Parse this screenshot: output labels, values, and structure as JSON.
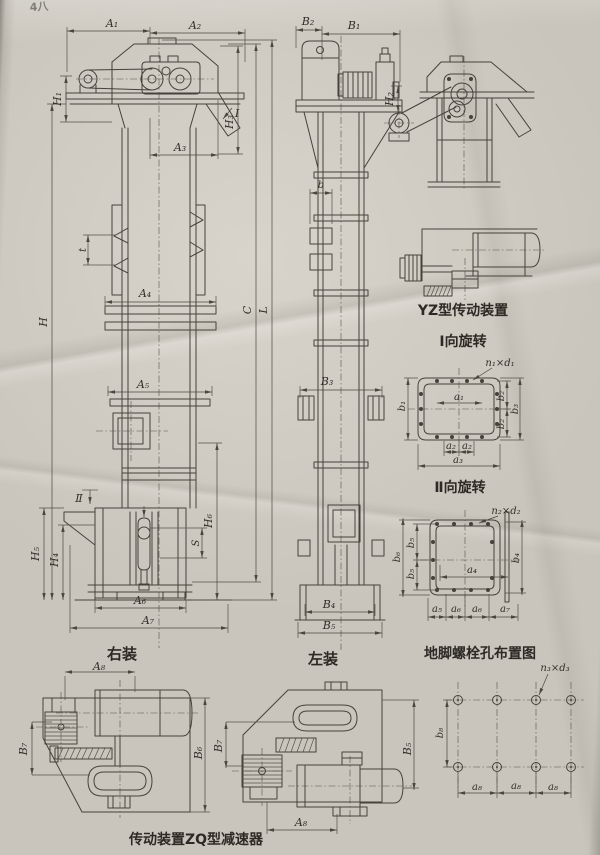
{
  "page": {
    "header_fragment": "4八",
    "views": {
      "front": {
        "caption": "右装",
        "dims": {
          "A1": "A₁",
          "A2": "A₂",
          "A3": "A₃",
          "A4": "A₄",
          "A5": "A₅",
          "A6": "A₆",
          "A7": "A₇",
          "H": "H",
          "H1": "H₁",
          "H3": "H₃",
          "H4": "H₄",
          "H5": "H₅",
          "H6": "H₆",
          "C": "C",
          "L": "L",
          "S": "S",
          "t": "t",
          "section1": "I",
          "section2": "Ⅱ"
        }
      },
      "side": {
        "caption": "左装",
        "dims": {
          "B1": "B₁",
          "B2": "B₂",
          "B3": "B₃",
          "B4": "B₄",
          "B5": "B₅",
          "H2": "H₂",
          "b": "b"
        }
      },
      "yz_drive": {
        "caption": "YZ型传动装置"
      },
      "flange1": {
        "caption": "Ⅰ向旋转",
        "dims": {
          "n1d1": "n₁×d₁",
          "a1": "a₁",
          "a2": "a₂",
          "a3": "a₃",
          "b1": "b₁",
          "b2": "b₂",
          "b3": "b₃"
        }
      },
      "flange2": {
        "caption": "Ⅱ向旋转",
        "dims": {
          "n2d2": "n₂×d₂",
          "a4": "a₄",
          "a5": "a₅",
          "a6": "a₆",
          "a7": "a₇",
          "b4": "b₄",
          "b5": "b₅",
          "b6": "b₆"
        }
      },
      "anchor": {
        "caption": "地脚螺栓孔布置图",
        "dims": {
          "n3d3": "n₃×d₃",
          "a8": "a₈",
          "b8": "b₈"
        }
      },
      "zq_drive": {
        "caption": "传动装置ZQ型减速器",
        "dims": {
          "A8": "A₈",
          "B5": "B₅",
          "B6": "B₆",
          "B7": "B₇"
        }
      }
    }
  }
}
